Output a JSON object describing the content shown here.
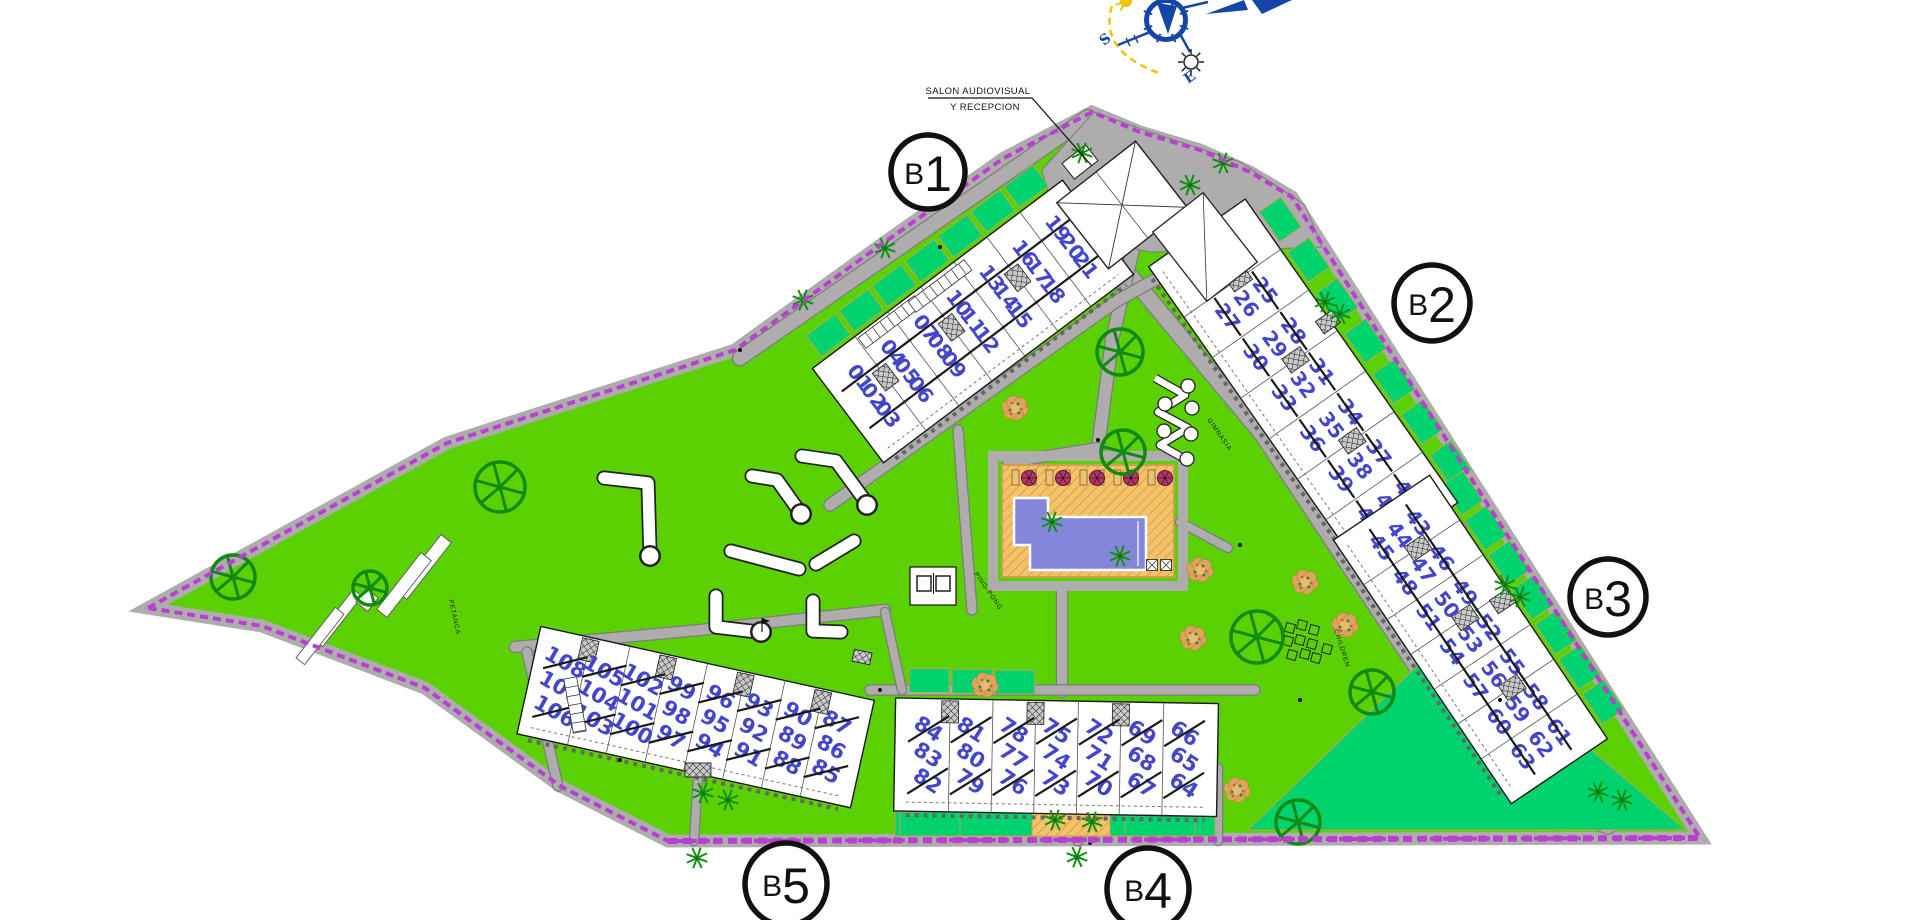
{
  "site": {
    "type": "residential resort site plan",
    "colors": {
      "lawn": "#5BD104",
      "garden": "#00D26E",
      "path": "#AEACAD",
      "path_edge": "#7E7C7D",
      "boundary": "#B83FD0",
      "building": "#FFFFFF",
      "building_line": "#1A1A1A",
      "unit_number": "#4345CC",
      "pool": "#8585DB",
      "sand": "#F2C36B",
      "sand_hatch": "#D98E20",
      "tan_edge": "#C8A050",
      "tree_green": "#128A12",
      "palm_green": "#109010",
      "bush_tan": "#DCA45F",
      "compass_blue": "#1545A8",
      "sun_yellow": "#EFC400",
      "parasol_red": "#B03868"
    }
  },
  "annotations": {
    "reception_label_line1": "SALON AUDIOVISUAL",
    "reception_label_line2": "Y RECEPCION"
  },
  "compass": {
    "south_label": "S",
    "east_label": "E"
  },
  "buildings": [
    {
      "badge": "B1",
      "blocks": [
        [
          "01",
          "02",
          "03"
        ],
        [
          "04",
          "05",
          "06"
        ],
        [
          "07",
          "08",
          "09"
        ],
        [
          "10",
          "11",
          "12"
        ],
        [
          "13",
          "14",
          "15"
        ],
        [
          "16",
          "17",
          "18"
        ],
        [
          "19",
          "20",
          "21"
        ]
      ]
    },
    {
      "badge": "B2",
      "blocks": [
        [
          "22",
          "23",
          "24"
        ],
        [
          "25",
          "26",
          "27"
        ],
        [
          "28",
          "29",
          "30"
        ],
        [
          "31",
          "32",
          "33"
        ],
        [
          "34",
          "35",
          "36"
        ],
        [
          "37",
          "38",
          "39"
        ],
        [
          "40",
          "41",
          "42"
        ]
      ]
    },
    {
      "badge": "B3",
      "blocks": [
        [
          "43",
          "44",
          "45"
        ],
        [
          "46",
          "47",
          "48"
        ],
        [
          "49",
          "50",
          "51"
        ],
        [
          "52",
          "53",
          "54"
        ],
        [
          "55",
          "56",
          "57"
        ],
        [
          "58",
          "59",
          "60"
        ],
        [
          "61",
          "62",
          "63"
        ]
      ]
    },
    {
      "badge": "B4",
      "blocks": [
        [
          "84",
          "83",
          "82"
        ],
        [
          "81",
          "80",
          "79"
        ],
        [
          "78",
          "77",
          "76"
        ],
        [
          "75",
          "74",
          "73"
        ],
        [
          "72",
          "71",
          "70"
        ],
        [
          "69",
          "68",
          "67"
        ],
        [
          "66",
          "65",
          "64"
        ]
      ]
    },
    {
      "badge": "B5",
      "blocks": [
        [
          "108",
          "107",
          "106"
        ],
        [
          "105",
          "104",
          "103"
        ],
        [
          "102",
          "101",
          "100"
        ],
        [
          "99",
          "98",
          "97"
        ],
        [
          "96",
          "95",
          "94"
        ],
        [
          "93",
          "92",
          "91"
        ],
        [
          "90",
          "89",
          "88"
        ],
        [
          "87",
          "86",
          "85"
        ]
      ]
    }
  ],
  "amenities": {
    "petanque": "PETANCA",
    "ping_pong": "PING-PONG",
    "gym": "GIMNASIA",
    "children": "CHILDREN"
  }
}
